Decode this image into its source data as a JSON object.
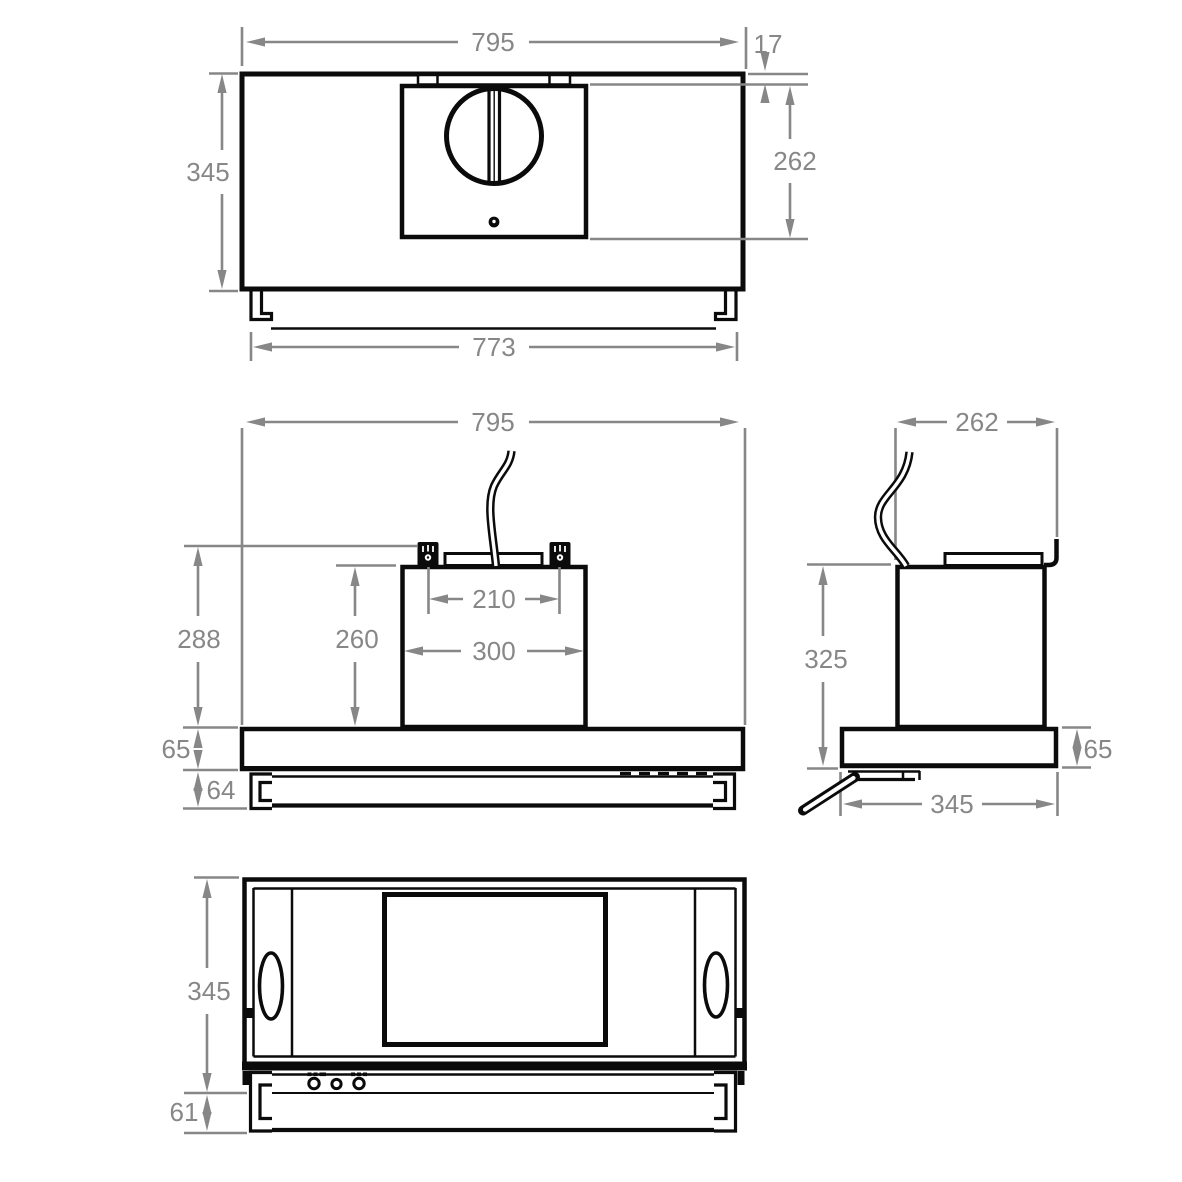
{
  "drawing": {
    "type": "technical-dimension-drawing",
    "subject": "cooker-hood-four-views",
    "colors": {
      "outline": "#0b0b0b",
      "dimension": "#878787",
      "background": "#ffffff"
    },
    "views": {
      "top": {
        "dims": {
          "overall_width": "795",
          "rear_offset": "17",
          "depth": "345",
          "motor_box_depth": "262",
          "mounting_width": "773"
        }
      },
      "front": {
        "dims": {
          "overall_width": "795",
          "hook_height": "288",
          "duct_height": "260",
          "hook_spacing": "210",
          "duct_width": "300",
          "body_height": "65",
          "visor_height": "64"
        }
      },
      "side": {
        "dims": {
          "duct_depth": "262",
          "overall_height": "325",
          "body_height": "65",
          "body_depth": "345"
        }
      },
      "bottom": {
        "dims": {
          "depth": "345",
          "visor_height": "61"
        }
      }
    }
  }
}
